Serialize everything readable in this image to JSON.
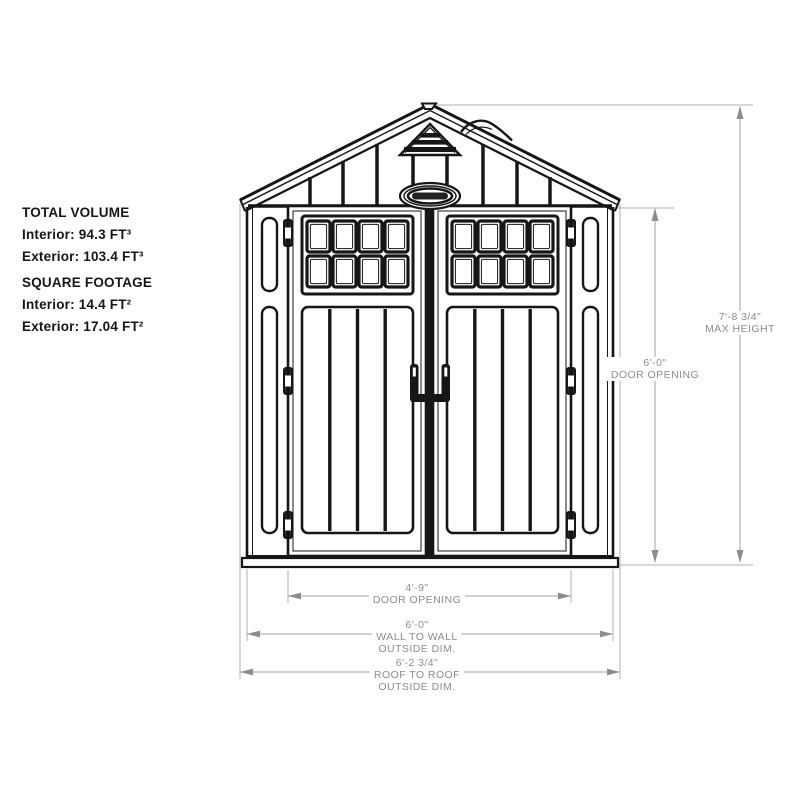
{
  "info_panel": {
    "sections": [
      {
        "heading": "TOTAL VOLUME",
        "lines": [
          "Interior: 94.3 FT³",
          "Exterior: 103.4 FT³"
        ]
      },
      {
        "heading": "SQUARE FOOTAGE",
        "lines": [
          "Interior: 14.4 FT²",
          "Exterior: 17.04 FT²"
        ]
      }
    ]
  },
  "dimensions": {
    "max_height": {
      "value": "7'-8 3/4\"",
      "label": "MAX HEIGHT"
    },
    "door_opening_height": {
      "value": "6'-0\"",
      "label": "DOOR OPENING"
    },
    "door_opening_width": {
      "value": "4'-9\"",
      "label": "DOOR OPENING"
    },
    "wall_to_wall": {
      "value": "6'-0\"",
      "label": "WALL TO WALL",
      "sublabel": "OUTSIDE DIM."
    },
    "roof_to_roof": {
      "value": "6'-2 3/4\"",
      "label": "ROOF TO ROOF",
      "sublabel": "OUTSIDE DIM."
    }
  },
  "drawing": {
    "line_color": "#161616",
    "dim_line_color": "#a8a8a8",
    "dim_text_color": "#8c8c8c",
    "background": "#ffffff"
  }
}
